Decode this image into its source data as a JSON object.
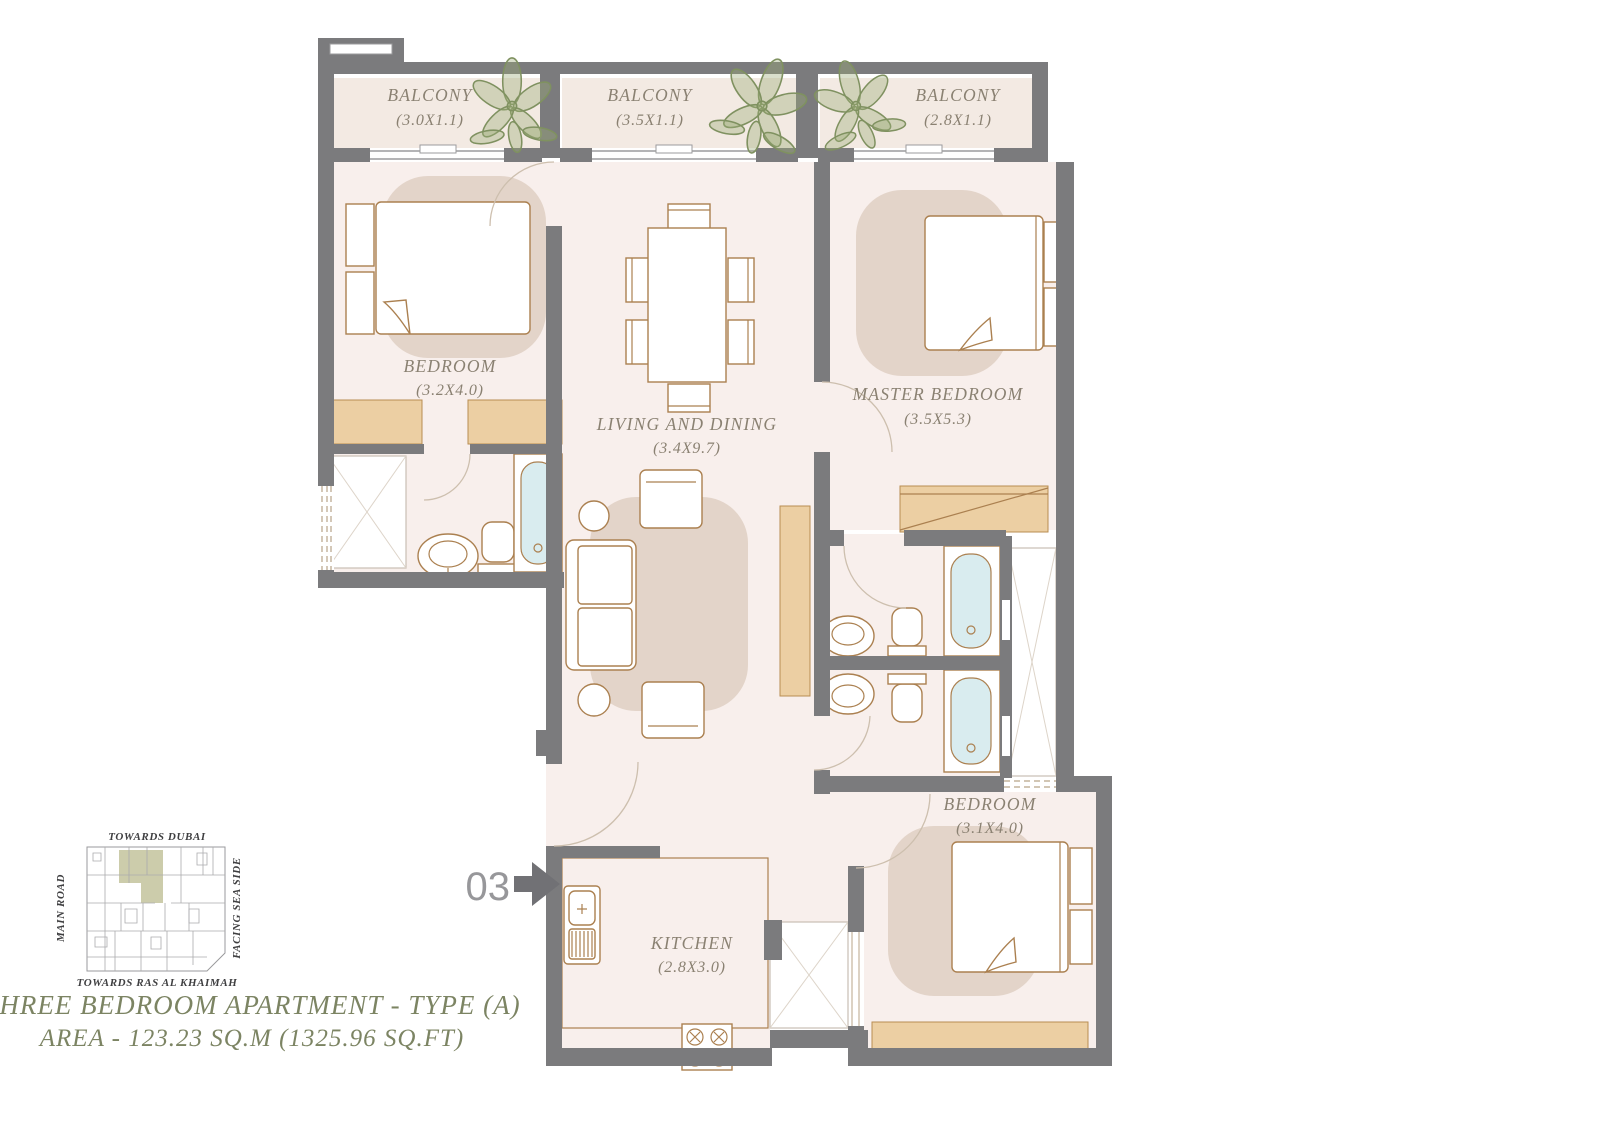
{
  "rooms": {
    "balcony_left": {
      "label": "BALCONY",
      "dim": "(3.0X1.1)"
    },
    "balcony_mid": {
      "label": "BALCONY",
      "dim": "(3.5X1.1)"
    },
    "balcony_right": {
      "label": "BALCONY",
      "dim": "(2.8X1.1)"
    },
    "bedroom_left": {
      "label": "BEDROOM",
      "dim": "(3.2X4.0)"
    },
    "living": {
      "label": "LIVING AND DINING",
      "dim": "(3.4X9.7)"
    },
    "master_bedroom": {
      "label": "MASTER BEDROOM",
      "dim": "(3.5X5.3)"
    },
    "bedroom_right": {
      "label": "BEDROOM",
      "dim": "(3.1X4.0)"
    },
    "kitchen": {
      "label": "KITCHEN",
      "dim": "(2.8X3.0)"
    }
  },
  "entrance": {
    "unit_number": "03",
    "arrow_icon": "entry-arrow-icon"
  },
  "keyplan": {
    "top_label": "TOWARDS DUBAI",
    "left_label": "MAIN ROAD",
    "right_label": "FACING SEA SIDE",
    "bottom_label": "TOWARDS RAS AL KHAIMAH"
  },
  "footer": {
    "title": "THREE BEDROOM APARTMENT - TYPE (A)",
    "area": "AREA - 123.23 SQ.M (1325.96 SQ.FT)"
  },
  "icons": {
    "plants": "balcony-plant-icon",
    "bath": "bathtub-icon",
    "sink": "sink-icon",
    "toilet": "toilet-icon",
    "stove": "stove-icon"
  },
  "colors": {
    "wall": "#7b7b7d",
    "floor": "#f8efec",
    "balcony_floor": "#f3eae3",
    "rug": "#e3d4c9",
    "wardrobe": "#eccfa3",
    "furniture_line": "#ab8050",
    "tub_water": "#d9ecef",
    "room_label": "#8a8172",
    "title_text": "#7c8463",
    "plant": "#7f9160",
    "highlight_unit": "#c6c6a2"
  }
}
